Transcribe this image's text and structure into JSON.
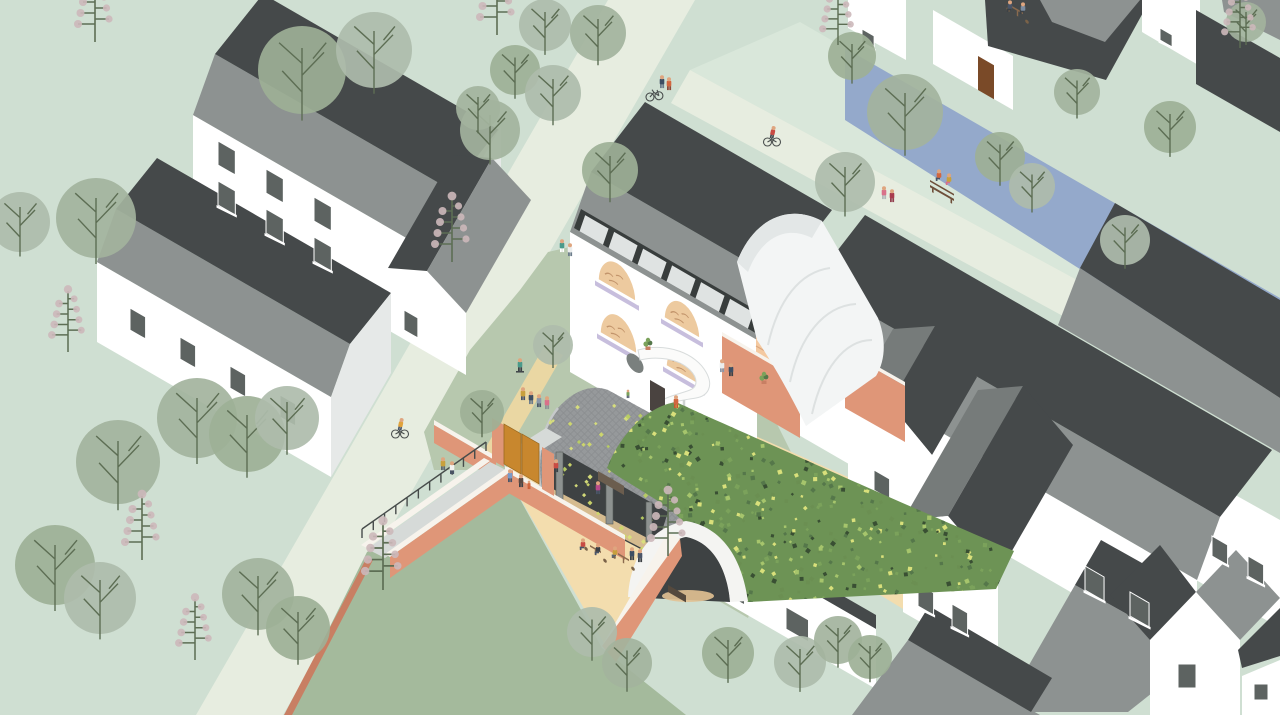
{
  "meta": {
    "title": "Axonometric illustration of a village block regeneration with green vaulted community hall, canal, houses, trees and people",
    "canvas_px": "1280x715"
  },
  "palette": {
    "bg": "#cfdfd2",
    "road": "#e7ede0",
    "bank": "#d9e7da",
    "canal": "#94a9cb",
    "sage": "#b7c8ae",
    "sagedark": "#8fae87",
    "lawn": "#a4ba9c",
    "tan": "#f3ddae",
    "path": "#ead7a3",
    "wall": "#ffffff",
    "gableLight": "#e6e9e8",
    "gableMid": "#c9cdcc",
    "roofMid": "#8d9291",
    "roofMid2": "#767b7a",
    "roofDark": "#45494a",
    "terracotta": "#df9678",
    "terraDark": "#c87f63",
    "terraTop": "#f7f3ec",
    "peach": "#f4c9a0",
    "gate": "#c8872e",
    "doorBrown": "#7a4a28",
    "fabric": "#f3f5f5",
    "vaultGray": "#96999b",
    "vaultInterior": "#3e4243",
    "archWhite": "#f4f4f2",
    "ramp": "#d6dad8",
    "clerestory": "#383d3c",
    "win": "#5d6361",
    "branch": "#5d6e54",
    "tree": "#aebcab",
    "tree2": "#a3b39d",
    "tree3": "#9db096",
    "blossom": "#ccb8ba",
    "skin": "#dfa57f",
    "archPeach": "#edca9f",
    "archLavender": "#c7bedd",
    "archDoodle": "#c2946b",
    "floorOrange": "#e78f4a",
    "benchBrown": "#6e4f3a",
    "glow": "#e2c294"
  },
  "scene": {
    "windows": [
      [
        218,
        165,
        20,
        24
      ],
      [
        266,
        193,
        20,
        24
      ],
      [
        314,
        221,
        20,
        24
      ],
      [
        218,
        205,
        20,
        24
      ],
      [
        266,
        233,
        20,
        24
      ],
      [
        314,
        261,
        20,
        24
      ],
      [
        404,
        330,
        16,
        20
      ],
      [
        130,
        330,
        18,
        22
      ],
      [
        180,
        359,
        18,
        22
      ],
      [
        230,
        388,
        18,
        22
      ],
      [
        280,
        417,
        18,
        22
      ],
      [
        862,
        42,
        14,
        13
      ],
      [
        1160,
        40,
        14,
        12
      ],
      [
        1212,
        556,
        18,
        20
      ],
      [
        1248,
        576,
        18,
        20
      ],
      [
        1085,
        590,
        22,
        24
      ],
      [
        1130,
        616,
        22,
        24
      ],
      [
        874,
        490,
        18,
        20
      ],
      [
        722,
        592,
        26,
        22
      ],
      [
        786,
        629,
        26,
        22
      ],
      [
        918,
        606,
        18,
        22
      ],
      [
        952,
        626,
        18,
        22
      ],
      [
        934,
        570,
        16,
        18
      ],
      [
        1178,
        688,
        18,
        24,
        "F"
      ],
      [
        1254,
        700,
        14,
        16,
        "F"
      ]
    ],
    "clerestory": {
      "x1": 574,
      "y1": 228,
      "x2": 759,
      "y2": 335,
      "panes": 6
    },
    "arches": [
      {
        "x": 597,
        "y": 280,
        "w": 40,
        "h": 30
      },
      {
        "x": 663,
        "y": 318,
        "w": 38,
        "h": 28
      },
      {
        "x": 599,
        "y": 333,
        "w": 39,
        "h": 30
      },
      {
        "x": 665,
        "y": 366,
        "w": 38,
        "h": 26
      }
    ],
    "trees_round": [
      [
        20,
        222,
        30
      ],
      [
        96,
        218,
        40
      ],
      [
        302,
        70,
        44
      ],
      [
        374,
        50,
        38
      ],
      [
        490,
        130,
        30
      ],
      [
        610,
        170,
        28
      ],
      [
        545,
        25,
        26
      ],
      [
        598,
        33,
        28
      ],
      [
        515,
        70,
        25
      ],
      [
        553,
        93,
        28
      ],
      [
        478,
        108,
        22
      ],
      [
        852,
        56,
        24
      ],
      [
        845,
        182,
        30
      ],
      [
        905,
        112,
        38
      ],
      [
        1000,
        157,
        25
      ],
      [
        1032,
        186,
        23
      ],
      [
        1077,
        92,
        23
      ],
      [
        1170,
        127,
        26
      ],
      [
        1125,
        240,
        25
      ],
      [
        1246,
        22,
        20
      ],
      [
        482,
        412,
        22
      ],
      [
        553,
        345,
        20
      ],
      [
        118,
        462,
        42
      ],
      [
        55,
        565,
        40
      ],
      [
        100,
        598,
        36
      ],
      [
        197,
        418,
        40
      ],
      [
        247,
        434,
        38
      ],
      [
        287,
        418,
        32
      ],
      [
        258,
        594,
        36
      ],
      [
        298,
        628,
        32
      ],
      [
        592,
        632,
        25
      ],
      [
        627,
        663,
        25
      ],
      [
        728,
        653,
        26
      ],
      [
        800,
        662,
        26
      ],
      [
        838,
        640,
        24
      ],
      [
        870,
        657,
        22
      ]
    ],
    "trees_blossom": [
      [
        95,
        42,
        1
      ],
      [
        68,
        352,
        0.95
      ],
      [
        452,
        262,
        1
      ],
      [
        497,
        35,
        1
      ],
      [
        838,
        45,
        0.9
      ],
      [
        1240,
        48,
        0.9
      ],
      [
        142,
        560,
        1
      ],
      [
        383,
        590,
        1.05
      ],
      [
        668,
        556,
        1
      ],
      [
        195,
        660,
        0.95
      ]
    ],
    "railings": [
      [
        362,
        538,
        486,
        451,
        11
      ]
    ],
    "people": [
      {
        "x": 662,
        "y": 88,
        "t": "#3d4e63",
        "b": "#6d7d8c",
        "k": "stand"
      },
      {
        "x": 669,
        "y": 90,
        "t": "#d2663f",
        "b": "#8a4a3a",
        "k": "stand"
      },
      {
        "x": 772,
        "y": 142,
        "t": "#c84b43",
        "b": "#44494f",
        "k": "cyclist"
      },
      {
        "x": 884,
        "y": 199,
        "t": "#d9708a",
        "b": "#b3b7ba",
        "k": "stand"
      },
      {
        "x": 892,
        "y": 202,
        "t": "#a83b4e",
        "b": "#93404f",
        "k": "stand"
      },
      {
        "x": 939,
        "y": 181,
        "t": "#d2663f",
        "b": "#4a5568",
        "k": "sit"
      },
      {
        "x": 949,
        "y": 185,
        "t": "#c8a03c",
        "b": "#d9708a",
        "k": "sit"
      },
      {
        "x": 1010,
        "y": 12,
        "t": "#4a5568",
        "b": "#3c4146",
        "k": "sit"
      },
      {
        "x": 1023,
        "y": 14,
        "t": "#7a8ba0",
        "b": "#3c4146",
        "k": "sit"
      },
      {
        "x": 400,
        "y": 434,
        "t": "#e0a23c",
        "b": "#4a5568",
        "k": "cyclist"
      },
      {
        "x": 520,
        "y": 371,
        "t": "#4a9a8a",
        "b": "#3c4146",
        "k": "skate"
      },
      {
        "x": 523,
        "y": 400,
        "t": "#c8a03c",
        "b": "#4a5568",
        "k": "stand"
      },
      {
        "x": 531,
        "y": 404,
        "t": "#3d4e63",
        "b": "#6d7d8c",
        "k": "stand"
      },
      {
        "x": 539,
        "y": 407,
        "t": "#8a97a8",
        "b": "#4a5568",
        "k": "stand"
      },
      {
        "x": 547,
        "y": 409,
        "t": "#d9708a",
        "b": "#8d9296",
        "k": "stand"
      },
      {
        "x": 562,
        "y": 252,
        "t": "#4a9a8a",
        "b": "#fefefe",
        "k": "stand"
      },
      {
        "x": 570,
        "y": 256,
        "t": "#eceeee",
        "b": "#6d7d8c",
        "k": "stand"
      },
      {
        "x": 510,
        "y": 482,
        "t": "#7a9ac8",
        "b": "#4a5568",
        "k": "stand"
      },
      {
        "x": 521,
        "y": 487,
        "t": "#5c4a42",
        "b": "#3c4146",
        "k": "stand"
      },
      {
        "x": 529,
        "y": 489,
        "t": "#d2663f",
        "b": "#c8582f",
        "k": "child"
      },
      {
        "x": 443,
        "y": 470,
        "t": "#c8a03c",
        "b": "#5c6670",
        "k": "stand"
      },
      {
        "x": 452,
        "y": 474,
        "t": "#f2f2f0",
        "b": "#4a5568",
        "k": "stand"
      },
      {
        "x": 722,
        "y": 372,
        "t": "#eceeee",
        "b": "#8a97a8",
        "k": "stand"
      },
      {
        "x": 731,
        "y": 376,
        "t": "#3d4e63",
        "b": "#3c4146",
        "k": "stand"
      },
      {
        "x": 676,
        "y": 408,
        "t": "#d2663f",
        "b": "#c8582f",
        "k": "stand"
      },
      {
        "x": 628,
        "y": 398,
        "t": "#7ba25b",
        "b": "#4a5568",
        "k": "child"
      },
      {
        "x": 583,
        "y": 550,
        "t": "#c84b43",
        "b": "#4a5568",
        "k": "sit"
      },
      {
        "x": 598,
        "y": 555,
        "t": "#3c4146",
        "b": "#4a5568",
        "k": "sit"
      },
      {
        "x": 615,
        "y": 558,
        "t": "#c8a03c",
        "b": "#5c6670",
        "k": "sit"
      },
      {
        "x": 632,
        "y": 560,
        "t": "#3d4e63",
        "b": "#3c4146",
        "k": "stand"
      },
      {
        "x": 640,
        "y": 562,
        "t": "#4a5568",
        "b": "#3c4146",
        "k": "stand"
      },
      {
        "x": 598,
        "y": 494,
        "t": "#b84a8a",
        "b": "#4a5568",
        "k": "stand"
      },
      {
        "x": 556,
        "y": 472,
        "t": "#c84b43",
        "b": "#3c4146",
        "k": "stand"
      }
    ],
    "props": {
      "benches": [
        [
          930,
          191
        ]
      ],
      "tables": [
        [
          590,
          552
        ],
        [
          618,
          560
        ],
        [
          1012,
          13
        ]
      ],
      "pots": [
        [
          648,
          350
        ],
        [
          764,
          384
        ]
      ],
      "bikes": [
        [
          650,
          97
        ]
      ]
    },
    "foliage": {
      "count": 720,
      "region": [
        600,
        396,
        420,
        212
      ],
      "colors": [
        "#7ba25b",
        "#55774a",
        "#394f33",
        "#a6c56c",
        "#6b8f52",
        "#d9e07b"
      ]
    },
    "sprinkles": {
      "count": 60,
      "region": [
        548,
        402,
        120,
        150
      ],
      "colors": [
        "#d9e07b",
        "#cfd86a",
        "#b9cf62"
      ]
    }
  }
}
